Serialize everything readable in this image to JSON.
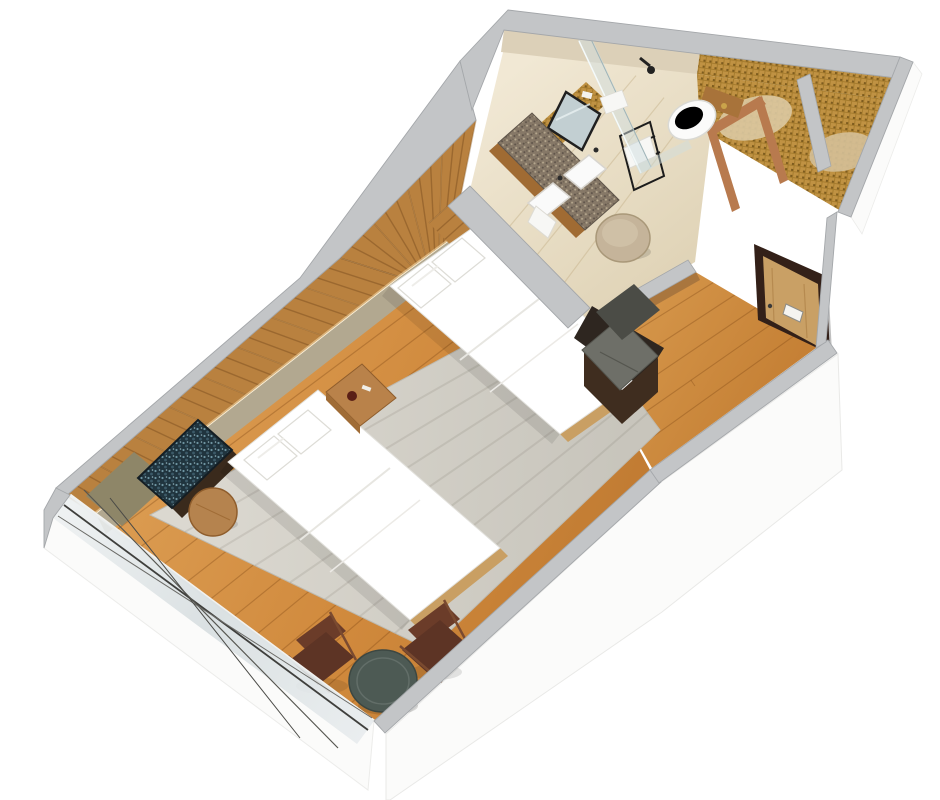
{
  "meta": {
    "type": "3d-isometric-floor-plan-render",
    "description": "Photorealistic cutaway 3D floor plan of a hotel twin guest room viewed from above at an angle, on a plain white background. No text is visible in the image.",
    "rooms": [
      "bedroom",
      "bathroom",
      "entry-corridor",
      "closet-alcoves",
      "balcony-window-wall"
    ]
  },
  "inventory": {
    "bedroom": [
      "twin-bed-near",
      "twin-bed-far",
      "pillows",
      "nightstand",
      "area-rug",
      "headboard-slat-wall",
      "led-cove-light",
      "wall-artwork",
      "round-side-stool",
      "round-lounge-table",
      "lounge-chair-left",
      "lounge-chair-right",
      "wood-plank-floor",
      "glass-window-wall"
    ],
    "bathroom": [
      "double-sink-vanity",
      "granite-countertop",
      "vanity-mirrors",
      "gold-mosaic-wall",
      "towel-ladder",
      "round-ottoman",
      "walk-in-shower",
      "shower-glass-panel",
      "shower-head",
      "toilet",
      "marble-floor"
    ],
    "entry": [
      "entry-door",
      "door-sign-plate",
      "luggage-bench",
      "corridor-wood-floor",
      "bathroom-door-frame"
    ]
  },
  "palette": {
    "background": "#ffffff",
    "wall_cap": "#c3c5c7",
    "wall_cap_edge": "#a4a7aa",
    "skirt": "#fbfbfa",
    "skirt_edge": "#e3e3e1",
    "glass": "#dde4e6",
    "glass_mullion": "#3f3f3c",
    "floor_wood": "#d0893c",
    "floor_wood_deep": "#bf7930",
    "floor_marble": "#e9dfc9",
    "rug": "#d6d3cb",
    "bed_linen": "#ffffff",
    "linen_shade": "#e7e6e2",
    "headboard_wood": "#b9813f",
    "lower_wall_tan": "#b2a890",
    "olive_wall": "#8e8668",
    "artwork_base": "#20343e",
    "ledge_brown": "#3a2a1c",
    "stool_wood": "#b5834e",
    "nightstand_wood": "#b9824a",
    "bench_cushion": "#6e6f68",
    "bench_base": "#3f2d1f",
    "counter_granite": "#867867",
    "sink_white": "#fafafa",
    "mirror_glass": "#c2cfd2",
    "mirror_frame": "#202020",
    "mosaic_gold": "#a67c2e",
    "towel_white": "#f7f7f5",
    "ladder_black": "#1c1c1c",
    "ottoman_beige": "#c5b49a",
    "toilet_white": "#fbfbfa",
    "shower_glass": "#cfdde0",
    "door_wood": "#c9a065",
    "door_frame": "#332018",
    "door_sign": "#f5f4f0",
    "table_top": "#4d5a54",
    "chair_leather": "#5d3425",
    "chair_wood": "#7a4a30",
    "copper_frame": "#b87a4e",
    "led_glow": "#ffe9bd",
    "shadow": "rgba(0,0,0,0.10)"
  }
}
